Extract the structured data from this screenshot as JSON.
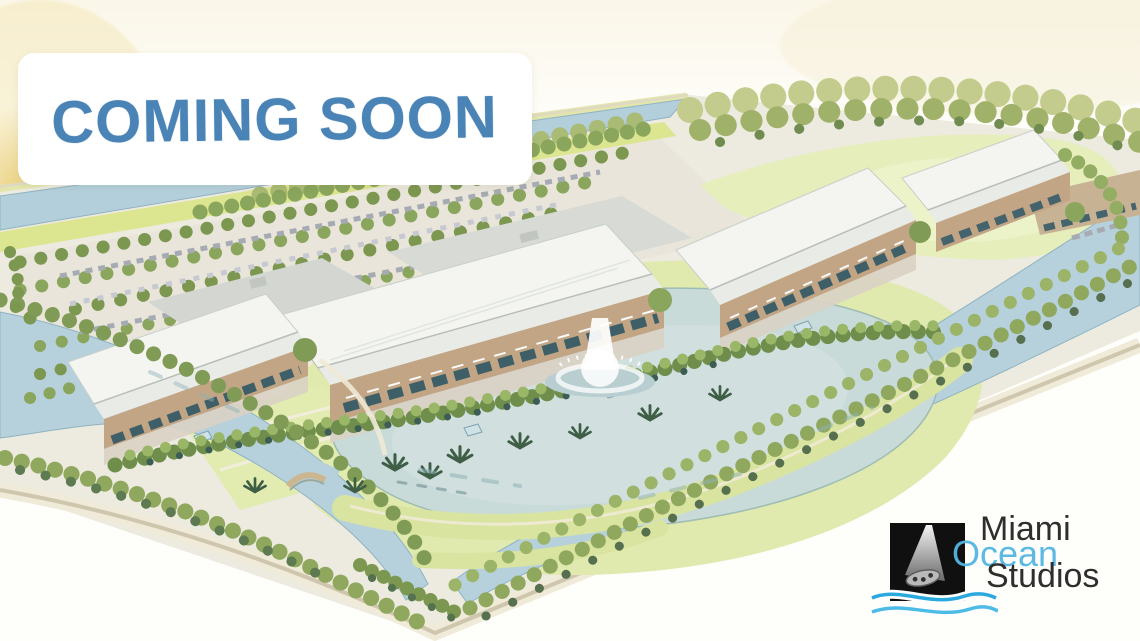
{
  "banner": {
    "text": "COMING SOON",
    "text_color": "#4a84b6",
    "bg_color": "#ffffff"
  },
  "logo": {
    "word_top": "Miami",
    "word_middle": "Ocean",
    "word_bottom": "Studios",
    "word_color_dark": "#2e2e2e",
    "word_color_ocean": "#54b6e2",
    "icon_name": "film-projector-beam-reel-icon",
    "icon_bg": "#101010",
    "wave_color": "#2aa9de"
  },
  "scene": {
    "palette": {
      "canal_water": "#b3cfdb",
      "lake_water": "#c9dbda",
      "lawn_green": "#e0e9ae",
      "tree_olive": "#7c9750",
      "tree_light": "#b9c383",
      "tree_dark": "#54724f",
      "roof_white": "#f4f5f1",
      "wall_tan": "#c2a585",
      "parking_gray": "#e9e5da",
      "wash_yellow": "#e7c766",
      "fountain_white": "#ffffff"
    }
  }
}
